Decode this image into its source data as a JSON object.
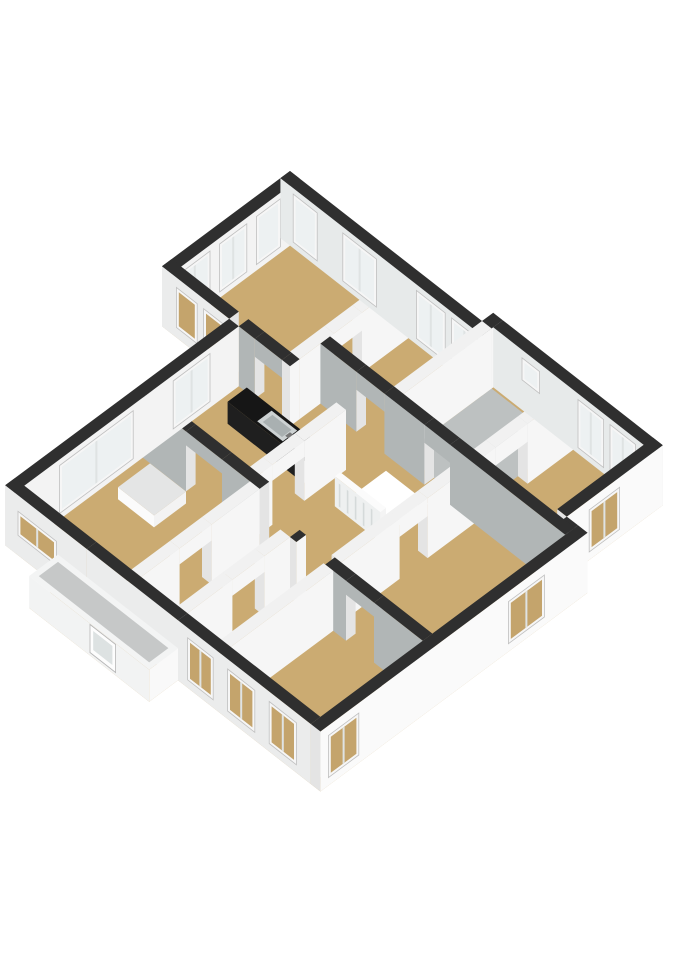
{
  "title": "3D floor plan - first floor",
  "projection": {
    "ox": 290,
    "oy": 231,
    "kx": 0.8,
    "kxy": 0.625,
    "kyy": 0.595,
    "wallH": 60
  },
  "palette": {
    "background": "#ffffff",
    "darkTop": "#2f2f2f",
    "lightTop": "#f1f1f1",
    "grayFace": "#b1b6b6",
    "whiteFace": "#f6f6f6",
    "endFace": "#e4e4e4",
    "nwInterior": "#f3f3f3",
    "neInterior": "#e7eaea",
    "seExterior": "#fafafa",
    "swExterior": "#ebecec",
    "floorTan": "#cbab72",
    "floorGray": "#bdc1c1",
    "stairVoid": "#ffffff",
    "windowFrame": "#f6f6f6",
    "windowFrameStroke": "#c0c0c0",
    "glassInside": "#edf1f2",
    "glassOutside": "#c4a46c",
    "mullion": "#dfe3e3",
    "counterTop": "#161616",
    "counterFace": "#1f1f1f",
    "sinkOuter": "#cdd2d3",
    "sinkInner": "#a9b0b1",
    "garageRoof": "#c6c8c8"
  },
  "floors": [
    {
      "name": "floor-main",
      "fill": "floorTan",
      "pts": [
        [
          0,
          0
        ],
        [
          252,
          0
        ],
        [
          252,
          -14
        ],
        [
          452,
          -14
        ],
        [
          452,
          106
        ],
        [
          478,
          106
        ],
        [
          478,
          440
        ],
        [
          300,
          440
        ],
        [
          300,
          476
        ],
        [
          150,
          476
        ],
        [
          150,
          440
        ],
        [
          84,
          440
        ],
        [
          84,
          160
        ],
        [
          0,
          160
        ]
      ]
    },
    {
      "name": "floor-bathroom",
      "fill": "floorGray",
      "pts": [
        [
          252,
          0
        ],
        [
          340,
          0
        ],
        [
          340,
          110
        ],
        [
          252,
          110
        ]
      ]
    },
    {
      "name": "floor-stairwell-void",
      "fill": "stairVoid",
      "pts": [
        [
          255,
          135
        ],
        [
          308,
          135
        ],
        [
          308,
          190
        ],
        [
          255,
          190
        ]
      ]
    }
  ],
  "boxes": [
    {
      "name": "wall-exterior-nw-topwing",
      "x1": 0,
      "y1": 0,
      "x2": 12,
      "y2": 160,
      "top": "darkTop",
      "faceX": "nwInterior",
      "win": [
        {
          "a": 24,
          "b": 54,
          "t": "in"
        },
        {
          "a": 66,
          "b": 100,
          "t": "in"
        },
        {
          "a": 112,
          "b": 150,
          "t": "in"
        }
      ]
    },
    {
      "name": "wall-exterior-ne-west",
      "x1": 0,
      "y1": 0,
      "x2": 252,
      "y2": 12,
      "top": "darkTop",
      "faceY": "neInterior",
      "win": [
        {
          "a": 16,
          "b": 46,
          "t": "in"
        },
        {
          "a": 78,
          "b": 120,
          "t": "in"
        },
        {
          "a": 170,
          "b": 206,
          "t": "in"
        },
        {
          "a": 214,
          "b": 246,
          "t": "in"
        }
      ]
    },
    {
      "name": "wall-exterior-ne-east",
      "x1": 252,
      "y1": -14,
      "x2": 452,
      "y2": -2,
      "top": "darkTop",
      "faceY": "neInterior",
      "win": [
        {
          "a": 288,
          "b": 310,
          "z0": 30,
          "z1": 52,
          "t": "in"
        },
        {
          "a": 358,
          "b": 390,
          "t": "in"
        },
        {
          "a": 398,
          "b": 430,
          "t": "in"
        }
      ]
    },
    {
      "name": "wall-exterior-ne-step",
      "x1": 240,
      "y1": -14,
      "x2": 252,
      "y2": 0,
      "top": "darkTop"
    },
    {
      "name": "wall-exterior-se-upper",
      "x1": 440,
      "y1": -14,
      "x2": 452,
      "y2": 106,
      "top": "darkTop",
      "faceX": "seExterior",
      "win": [
        {
          "a": 40,
          "b": 78,
          "z0": 8,
          "z1": 50,
          "t": "out"
        }
      ]
    },
    {
      "name": "wall-exterior-se-step",
      "x1": 452,
      "y1": 106,
      "x2": 466,
      "y2": 118,
      "top": "darkTop",
      "faceY": "swExterior"
    },
    {
      "name": "wall-exterior-se-lower",
      "x1": 466,
      "y1": 106,
      "x2": 478,
      "y2": 440,
      "top": "darkTop",
      "faceX": "seExterior",
      "win": [
        {
          "a": 160,
          "b": 205,
          "z0": 8,
          "z1": 50,
          "t": "out"
        },
        {
          "a": 392,
          "b": 430,
          "z0": 8,
          "z1": 50,
          "t": "out"
        }
      ]
    },
    {
      "name": "wall-exterior-sw-main",
      "x1": 300,
      "y1": 428,
      "x2": 466,
      "y2": 440,
      "top": "darkTop",
      "faceY": "swExterior",
      "win": [
        {
          "a": 312,
          "b": 344,
          "z0": 8,
          "z1": 50,
          "t": "out"
        },
        {
          "a": 362,
          "b": 396,
          "z0": 8,
          "z1": 50,
          "t": "out"
        },
        {
          "a": 414,
          "b": 448,
          "z0": 8,
          "z1": 50,
          "t": "out"
        }
      ]
    },
    {
      "name": "wall-exterior-sw-center",
      "x1": 186,
      "y1": 428,
      "x2": 300,
      "y2": 440,
      "top": "darkTop",
      "faceY": "swExterior"
    },
    {
      "name": "wall-exterior-sw-left",
      "x1": 84,
      "y1": 428,
      "x2": 186,
      "y2": 440,
      "top": "darkTop",
      "faceY": "swExterior",
      "win": [
        {
          "a": 100,
          "b": 148,
          "z0": 20,
          "z1": 44,
          "t": "out"
        }
      ]
    },
    {
      "name": "wall-exterior-nw-left",
      "x1": 84,
      "y1": 160,
      "x2": 96,
      "y2": 440,
      "top": "darkTop",
      "faceX": "nwInterior",
      "win": [
        {
          "a": 196,
          "b": 242,
          "t": "in"
        },
        {
          "a": 292,
          "b": 384,
          "t": "in"
        }
      ]
    },
    {
      "name": "wall-exterior-sw-topwing",
      "x1": 0,
      "y1": 148,
      "x2": 84,
      "y2": 160,
      "top": "darkTop",
      "faceY": "swExterior",
      "win": [
        {
          "a": 18,
          "b": 44,
          "z0": 10,
          "z1": 50,
          "t": "out"
        },
        {
          "a": 52,
          "b": 76,
          "z0": 10,
          "z1": 50,
          "t": "out"
        }
      ]
    },
    {
      "name": "wall-bedroom-divider-a",
      "x1": 148,
      "y1": 12,
      "x2": 160,
      "y2": 70
    },
    {
      "name": "door-header-bedroom-divider",
      "x1": 148,
      "y1": 70,
      "x2": 160,
      "y2": 105,
      "z0": 42
    },
    {
      "name": "wall-bedroom-divider-b",
      "x1": 148,
      "y1": 105,
      "x2": 160,
      "y2": 148
    },
    {
      "name": "wall-wing-south-a",
      "x1": 96,
      "y1": 148,
      "x2": 116,
      "y2": 160,
      "top": "darkTop"
    },
    {
      "name": "door-header-wing",
      "x1": 116,
      "y1": 148,
      "x2": 150,
      "y2": 160,
      "z0": 42,
      "top": "darkTop"
    },
    {
      "name": "wall-wing-south-b",
      "x1": 150,
      "y1": 148,
      "x2": 160,
      "y2": 160,
      "top": "darkTop"
    },
    {
      "name": "wall-north-corridor-a",
      "x1": 160,
      "y1": 110,
      "x2": 205,
      "y2": 122,
      "top": "darkTop"
    },
    {
      "name": "door-header-midbedroom",
      "x1": 205,
      "y1": 110,
      "x2": 240,
      "y2": 122,
      "z0": 42,
      "top": "darkTop"
    },
    {
      "name": "wall-north-corridor-b",
      "x1": 240,
      "y1": 110,
      "x2": 290,
      "y2": 122,
      "top": "darkTop"
    },
    {
      "name": "door-header-bathroom",
      "x1": 290,
      "y1": 110,
      "x2": 322,
      "y2": 122,
      "z0": 42,
      "top": "darkTop"
    },
    {
      "name": "wall-north-corridor-c",
      "x1": 322,
      "y1": 110,
      "x2": 466,
      "y2": 122,
      "top": "darkTop"
    },
    {
      "name": "wall-bathroom-west",
      "x1": 240,
      "y1": 0,
      "x2": 252,
      "y2": 110
    },
    {
      "name": "wall-bathroom-east-a",
      "x1": 340,
      "y1": -2,
      "x2": 352,
      "y2": 55
    },
    {
      "name": "door-header-right-bedroom",
      "x1": 340,
      "y1": 55,
      "x2": 352,
      "y2": 95,
      "z0": 42
    },
    {
      "name": "wall-bathroom-east-b",
      "x1": 340,
      "y1": 95,
      "x2": 352,
      "y2": 110
    },
    {
      "name": "wall-hall-east-a",
      "x1": 340,
      "y1": 122,
      "x2": 352,
      "y2": 180
    },
    {
      "name": "door-header-middle-bedroom",
      "x1": 340,
      "y1": 180,
      "x2": 352,
      "y2": 215,
      "z0": 42
    },
    {
      "name": "wall-hall-east-b",
      "x1": 340,
      "y1": 215,
      "x2": 352,
      "y2": 288
    },
    {
      "name": "wall-mid-south-a",
      "x1": 300,
      "y1": 288,
      "x2": 308,
      "y2": 300,
      "top": "darkTop"
    },
    {
      "name": "wall-mid-south-b",
      "x1": 344,
      "y1": 288,
      "x2": 370,
      "y2": 300,
      "top": "darkTop"
    },
    {
      "name": "arch-header-bottomright",
      "x1": 370,
      "y1": 288,
      "x2": 405,
      "y2": 300,
      "z0": 46,
      "top": "darkTop"
    },
    {
      "name": "wall-mid-south-c",
      "x1": 405,
      "y1": 288,
      "x2": 466,
      "y2": 300,
      "top": "darkTop"
    },
    {
      "name": "wall-bottomright-west",
      "x1": 342,
      "y1": 300,
      "x2": 354,
      "y2": 428
    },
    {
      "name": "wall-kitchen-hall-a",
      "x1": 218,
      "y1": 160,
      "x2": 230,
      "y2": 212
    },
    {
      "name": "door-header-kitchen",
      "x1": 218,
      "y1": 212,
      "x2": 230,
      "y2": 252,
      "z0": 44
    },
    {
      "name": "wall-kitchen-hall-b",
      "x1": 218,
      "y1": 252,
      "x2": 230,
      "y2": 268
    },
    {
      "name": "wall-kitchen-living-a",
      "x1": 96,
      "y1": 268,
      "x2": 150,
      "y2": 280,
      "top": "darkTop"
    },
    {
      "name": "arch-header-kitchen-living",
      "x1": 150,
      "y1": 268,
      "x2": 195,
      "y2": 280,
      "z0": 46,
      "top": "darkTop"
    },
    {
      "name": "wall-kitchen-living-b",
      "x1": 195,
      "y1": 268,
      "x2": 242,
      "y2": 280,
      "top": "darkTop"
    },
    {
      "name": "wall-corridor-west-a",
      "x1": 230,
      "y1": 280,
      "x2": 242,
      "y2": 340
    },
    {
      "name": "arch-header-left-room",
      "x1": 230,
      "y1": 340,
      "x2": 242,
      "y2": 380,
      "z0": 44
    },
    {
      "name": "wall-corridor-west-b",
      "x1": 230,
      "y1": 380,
      "x2": 242,
      "y2": 428
    },
    {
      "name": "wall-bottomroom-west-a",
      "x1": 288,
      "y1": 300,
      "x2": 300,
      "y2": 332
    },
    {
      "name": "arch-header-bottom-room",
      "x1": 288,
      "y1": 332,
      "x2": 300,
      "y2": 372,
      "z0": 44
    },
    {
      "name": "wall-bottomroom-west-b",
      "x1": 288,
      "y1": 372,
      "x2": 300,
      "y2": 428
    },
    {
      "name": "kitchen-counter",
      "x1": 120,
      "y1": 174,
      "x2": 215,
      "y2": 198,
      "z1": 22,
      "top": "counterTop",
      "faceY": "counterFace",
      "faceX": "#ededed"
    },
    {
      "name": "floor-object-left-room",
      "x1": 115,
      "y1": 290,
      "x2": 160,
      "y2": 330,
      "z1": 12,
      "top": "#e4e5e5",
      "faceY": "#fbfbfb",
      "faceX": "#f3f3f3"
    },
    {
      "name": "stair-railing",
      "x1": 253,
      "y1": 190,
      "x2": 310,
      "y2": 197,
      "z1": 30,
      "top": "#fbfbfb",
      "faceY": "#eef0f0",
      "faceX": "#f4f4f4"
    },
    {
      "name": "garage-volume",
      "x1": 150,
      "y1": 440,
      "x2": 300,
      "y2": 476,
      "z1": 32,
      "top": "#f3f4f4",
      "faceY": "#f2f3f3",
      "faceX": "#f9f9f9"
    }
  ],
  "deco": [
    {
      "name": "sink-basin-outer",
      "d": 414,
      "fill": "sinkOuter",
      "pts": [
        [
          154,
          177,
          22
        ],
        [
          186,
          177,
          22
        ],
        [
          186,
          195,
          22
        ],
        [
          154,
          195,
          22
        ]
      ]
    },
    {
      "name": "sink-basin-inner",
      "d": 415,
      "fill": "sinkInner",
      "pts": [
        [
          158,
          180,
          22
        ],
        [
          182,
          180,
          22
        ],
        [
          182,
          192,
          22
        ],
        [
          158,
          192,
          22
        ]
      ]
    },
    {
      "name": "sink-faucet",
      "d": 416,
      "fill": "#777777",
      "pts": [
        [
          183,
          183,
          22
        ],
        [
          187,
          183,
          22
        ],
        [
          187,
          189,
          22
        ],
        [
          183,
          189,
          22
        ]
      ]
    },
    {
      "name": "railing-baluster-1",
      "d": 508,
      "fill": "#d5dada",
      "pts": [
        [
          258,
          197,
          3
        ],
        [
          260,
          197,
          3
        ],
        [
          260,
          197,
          26
        ],
        [
          258,
          197,
          26
        ]
      ]
    },
    {
      "name": "railing-baluster-2",
      "d": 508,
      "fill": "#d5dada",
      "pts": [
        [
          268,
          197,
          3
        ],
        [
          270,
          197,
          3
        ],
        [
          270,
          197,
          26
        ],
        [
          268,
          197,
          26
        ]
      ]
    },
    {
      "name": "railing-baluster-3",
      "d": 508,
      "fill": "#d5dada",
      "pts": [
        [
          278,
          197,
          3
        ],
        [
          280,
          197,
          3
        ],
        [
          280,
          197,
          26
        ],
        [
          278,
          197,
          26
        ]
      ]
    },
    {
      "name": "railing-baluster-4",
      "d": 508,
      "fill": "#d5dada",
      "pts": [
        [
          288,
          197,
          3
        ],
        [
          290,
          197,
          3
        ],
        [
          290,
          197,
          26
        ],
        [
          288,
          197,
          26
        ]
      ]
    },
    {
      "name": "railing-baluster-5",
      "d": 508,
      "fill": "#d5dada",
      "pts": [
        [
          298,
          197,
          3
        ],
        [
          300,
          197,
          3
        ],
        [
          300,
          197,
          26
        ],
        [
          298,
          197,
          26
        ]
      ]
    },
    {
      "name": "garage-roof-inset",
      "d": 777,
      "fill": "garageRoof",
      "pts": [
        [
          156,
          446,
          32
        ],
        [
          294,
          446,
          32
        ],
        [
          294,
          470,
          32
        ],
        [
          156,
          470,
          32
        ]
      ]
    },
    {
      "name": "entry-door",
      "d": 778,
      "fill": "#fdfdfd",
      "stroke": "#b5b5b5",
      "pts": [
        [
          226,
          476,
          3
        ],
        [
          258,
          476,
          3
        ],
        [
          258,
          476,
          31
        ],
        [
          226,
          476,
          31
        ]
      ]
    },
    {
      "name": "entry-door-glass",
      "d": 779,
      "fill": "#dde2e2",
      "pts": [
        [
          230,
          476,
          8
        ],
        [
          254,
          476,
          8
        ],
        [
          254,
          476,
          27
        ],
        [
          230,
          476,
          27
        ]
      ]
    }
  ]
}
